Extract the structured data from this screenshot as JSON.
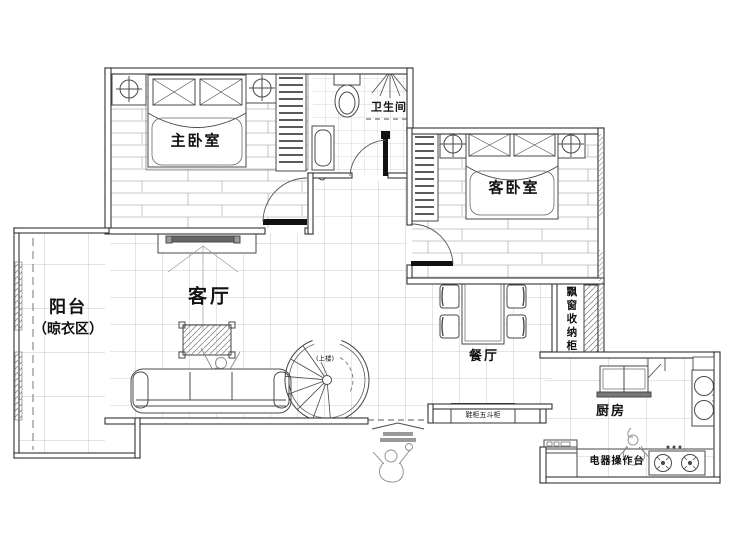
{
  "meta": {
    "drawing_type": "apartment floor plan",
    "language": "zh-CN"
  },
  "colors": {
    "background": "#ffffff",
    "wall_line": "#333333",
    "furniture_line": "#4a4a4a",
    "grid_line": "#c0c0c0",
    "text": "#111111"
  },
  "rooms": {
    "master_bedroom": {
      "label": "主卧室"
    },
    "bathroom": {
      "label": "卫生间"
    },
    "guest_bedroom": {
      "label": "客卧室"
    },
    "balcony": {
      "label": "阳台",
      "sublabel": "（晾衣区）"
    },
    "living_room": {
      "label": "客厅"
    },
    "dining_room": {
      "label": "餐厅"
    },
    "kitchen": {
      "label": "厨房"
    }
  },
  "annotations": {
    "bay_window_cabinet": {
      "label": "飘窗收纳柜"
    },
    "appliance_counter": {
      "label": "电器操作台"
    },
    "shoe_cabinet": {
      "label": "鞋柜五斗柜"
    },
    "stair_direction": {
      "label": "(上楼)"
    }
  }
}
